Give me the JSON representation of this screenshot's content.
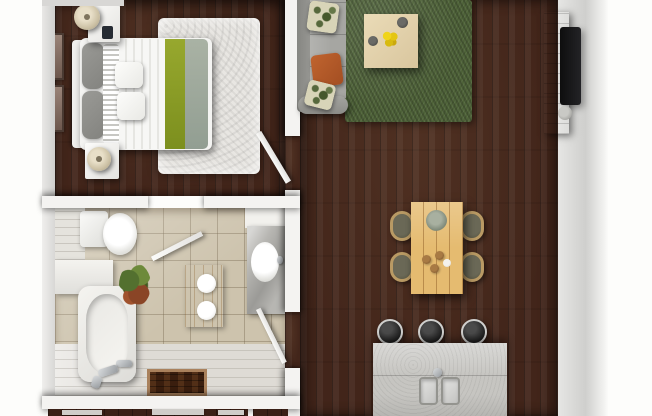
{
  "scene": {
    "kind": "3d-rendered-floor-plan",
    "view": "top-down",
    "rooms": [
      {
        "name": "bedroom",
        "items": [
          "double-bed",
          "headboard",
          "gray-pillows",
          "striped-pillows",
          "white-accent-pillows",
          "striped-duvet",
          "lime-green-throw",
          "sage-blanket",
          "white-shag-rug",
          "nightstand-top",
          "nightstand-bottom",
          "table-lamp-top",
          "table-lamp-bottom",
          "phone-on-nightstand",
          "wall-art-frame-1",
          "wall-art-frame-2",
          "door-to-living-room"
        ]
      },
      {
        "name": "bathroom",
        "items": [
          "toilet",
          "bathtub",
          "tub-faucet",
          "handheld-shower",
          "tub-deck",
          "potted-plant",
          "wood-bath-mat",
          "rolled-towel-1",
          "rolled-towel-2",
          "vanity-counter",
          "marble-top",
          "oval-sink",
          "wood-floor-inset",
          "door-to-bedroom",
          "door-to-living-room"
        ]
      },
      {
        "name": "living-kitchen",
        "items": [
          "gray-sectional-sofa",
          "leaf-pattern-pillow-1",
          "leaf-pattern-pillow-2",
          "orange-pillow",
          "green-shag-rug",
          "square-coffee-table",
          "yellow-flower-bowl",
          "decor-bowl-1",
          "decor-bowl-2",
          "tv-console",
          "wall-mounted-tv",
          "speaker",
          "dining-table",
          "dining-chair-1",
          "dining-chair-2",
          "dining-chair-3",
          "dining-chair-4",
          "plant-centerpiece",
          "table-bowls",
          "kitchen-island",
          "double-basin-sink",
          "island-faucet",
          "bar-stool-1",
          "bar-stool-2",
          "bar-stool-3"
        ]
      }
    ]
  },
  "colors": {
    "floor_wood": "#42251a",
    "wall_white": "#f4f3f1",
    "wall_gray": "#cfcfcd",
    "rug_white": "#e8e6e2",
    "rug_green": "#4e6238",
    "sofa_gray": "#a6a6a2",
    "pillow_orange": "#a34e22",
    "pillow_leaf": "#d8d4b8",
    "bed_lime": "#97a82e",
    "bed_sage": "#a9b2a4",
    "table_oak": "#e5bb70",
    "coffee_table": "#d9c69e",
    "chair_cushion": "#55533f",
    "chair_frame": "#b99a64",
    "island_concrete": "#c6c5c1",
    "stool_black": "#161616",
    "tile_beige": "#cdc3ad",
    "tile_white": "#dedbd5",
    "bath_mat_wood": "#cf9a42",
    "tv_console_wood": "#b88f2e",
    "tv_black": "#232326",
    "flower_yellow": "#e4c513",
    "plant_green": "#53702f",
    "plant_red": "#8a4526"
  }
}
